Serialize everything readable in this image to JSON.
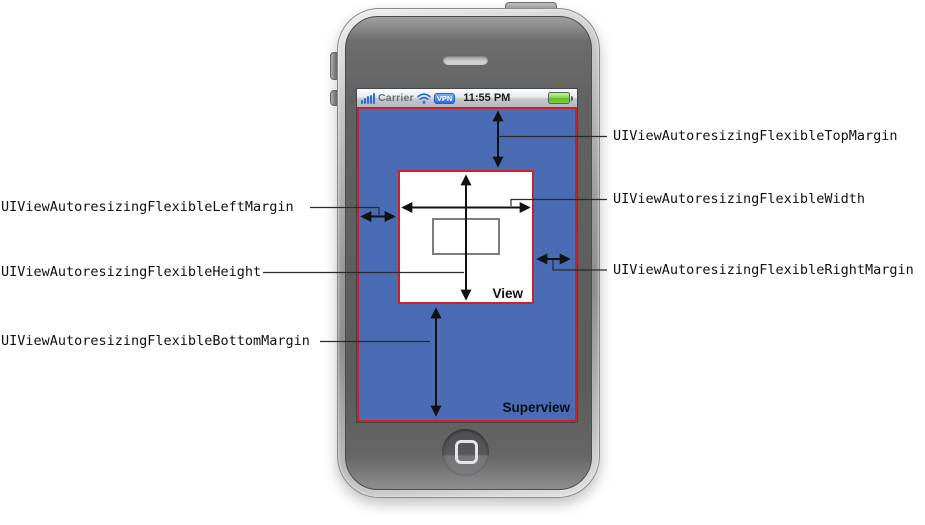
{
  "page": {
    "background_color": "#ffffff"
  },
  "device": {
    "type": "iphone",
    "status_bar": {
      "carrier_label": "Carrier",
      "vpn_badge_label": "VPN",
      "time": "11:55 PM",
      "icon_color": "#2a6ce0",
      "battery_color": "#7ed23f"
    }
  },
  "diagram": {
    "superview": {
      "label": "Superview",
      "fill_color": "#4a6cb4",
      "border_color": "#cc2127"
    },
    "view": {
      "label": "View",
      "fill_color": "#ffffff",
      "border_color": "#cc2127"
    },
    "arrow_color": "#111111",
    "annotations": {
      "left": [
        {
          "text": "UIViewAutoresizingFlexibleLeftMargin"
        },
        {
          "text": "UIViewAutoresizingFlexibleHeight"
        },
        {
          "text": "UIViewAutoresizingFlexibleBottomMargin"
        }
      ],
      "right": [
        {
          "text": "UIViewAutoresizingFlexibleTopMargin"
        },
        {
          "text": "UIViewAutoresizingFlexibleWidth"
        },
        {
          "text": "UIViewAutoresizingFlexibleRightMargin"
        }
      ]
    }
  }
}
